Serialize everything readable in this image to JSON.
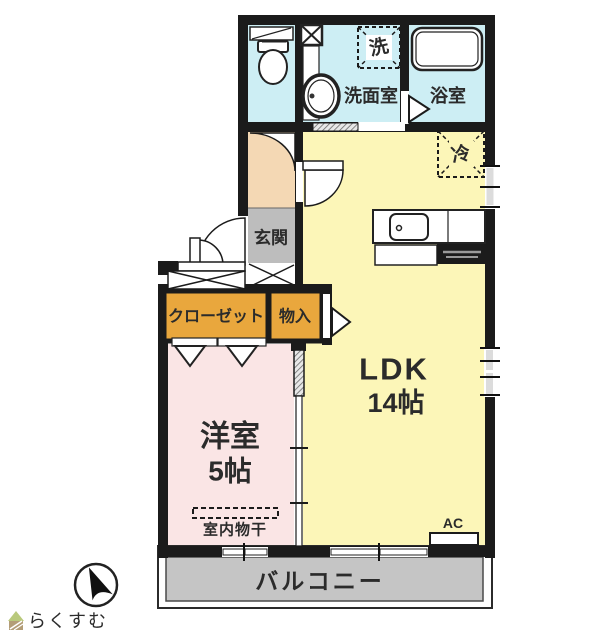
{
  "labels": {
    "washer": "洗",
    "washroom": "洗面室",
    "bathroom": "浴室",
    "fridge": "冷",
    "entrance": "玄関",
    "closet": "クローゼット",
    "storage": "物入",
    "ldk_name": "LDK",
    "ldk_size": "14帖",
    "western_name": "洋室",
    "western_size": "5帖",
    "indoor_laundry": "室内物干",
    "ac": "AC",
    "balcony": "バルコニー"
  },
  "branding": {
    "logo_text": "らくすむ"
  },
  "colors": {
    "wet": "#cdeef4",
    "hallway": "#f4d8b4",
    "entrance": "#bdbdbd",
    "closet": "#e9a73d",
    "ldk": "#fcf6b8",
    "western": "#fae5e5",
    "balcony": "#c5c5c5",
    "wall": "#1b1b1b",
    "logo_text": "#c2ad87",
    "logo_roof": "#b9c97c",
    "logo_body": "#b39d77"
  }
}
